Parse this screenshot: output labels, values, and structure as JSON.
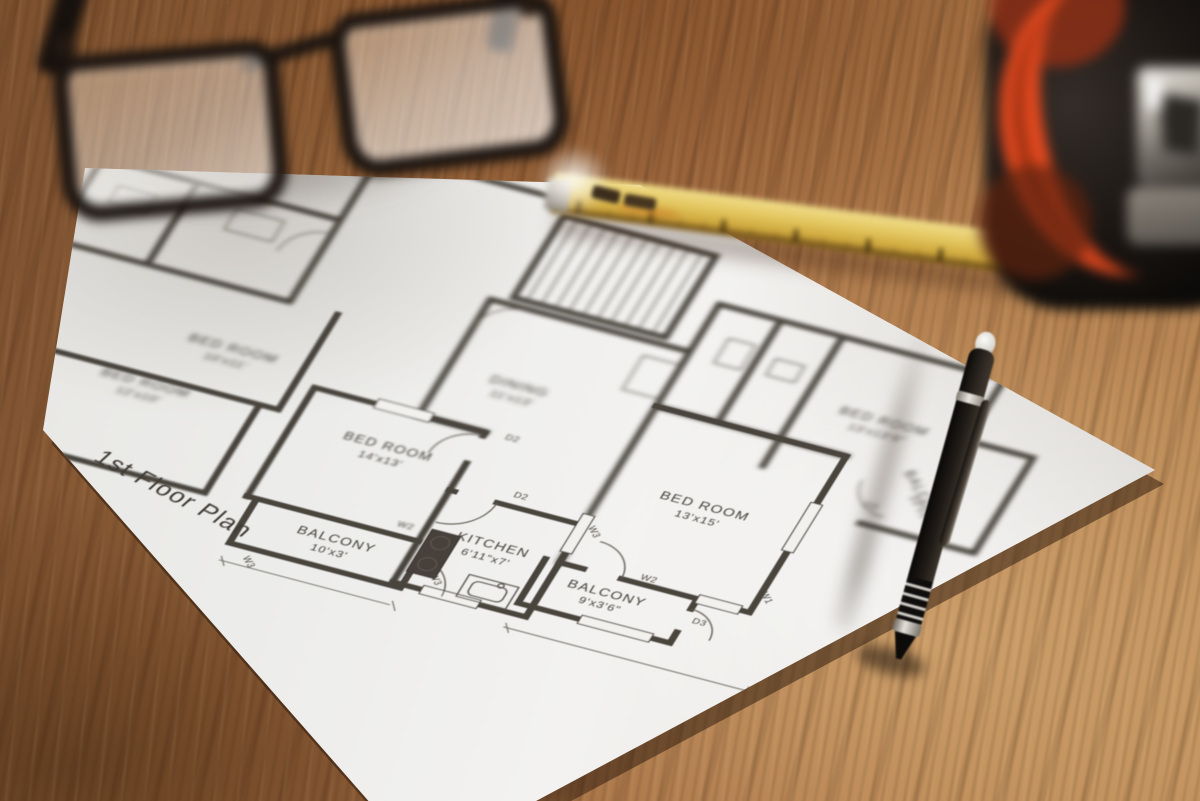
{
  "plan": {
    "title": "1st Floor Plan",
    "rooms": [
      {
        "name": "BED ROOM",
        "dims": "14'x13'"
      },
      {
        "name": "BALCONY",
        "dims": "10'x3'"
      },
      {
        "name": "KITCHEN",
        "dims": "6'11\"x7'"
      },
      {
        "name": "DINING",
        "dims": "11'x13'"
      },
      {
        "name": "BED ROOM",
        "dims": "13'x15'"
      },
      {
        "name": "BALCONY",
        "dims": "9'x3'6\""
      },
      {
        "name": "BED ROOM",
        "dims": "13'x13'6\""
      },
      {
        "name": "BALCONY",
        "dims": "10'x3'6\""
      },
      {
        "name": "BED ROOM",
        "dims": "12'x10'"
      },
      {
        "name": "BED ROOM",
        "dims": "10'x11'"
      }
    ],
    "markers": {
      "d2": "D2",
      "d3": "D3",
      "w1": "W1",
      "w2": "W2",
      "w3": "W3"
    }
  },
  "colors": {
    "wood": "#96633a",
    "paper": "#efeeec",
    "ink": "#46403a",
    "ruler_yellow": "#d9bd55",
    "tape_orange": "#e2491f",
    "pen_black": "#15110e",
    "glasses_frame": "#1b1410"
  }
}
